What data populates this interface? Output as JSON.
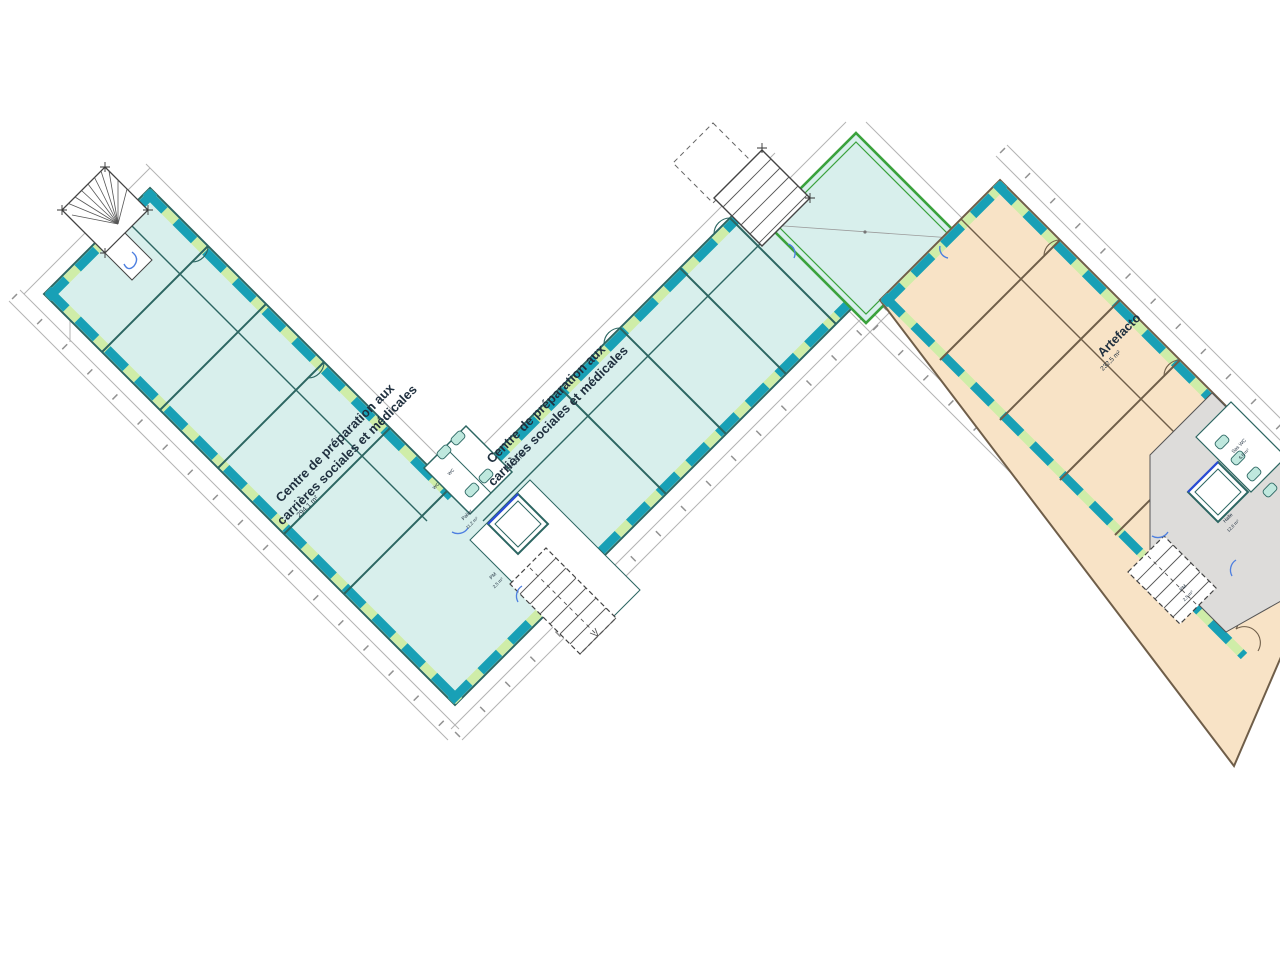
{
  "plan": {
    "zones": {
      "centre_left": {
        "line1": "Centre de préparation aux",
        "line2": "carrières sociales et médicales",
        "area": "294,1 m²"
      },
      "centre_mid": {
        "line1": "Centre de préparation aux",
        "line2": "carrières sociales et médicales",
        "area": "294,6 m²"
      },
      "artefacto": {
        "name": "Artefacto",
        "area": "232,5 m²"
      }
    },
    "core_left": {
      "palier": "Palier",
      "palier_area": "11,2 m²",
      "pm": "PM",
      "pm_area": "2,5 m²",
      "wc1": "WC",
      "wc2": "WC"
    },
    "core_right": {
      "halle": "Halle",
      "halle_area": "12,6 m²",
      "sas_wc": "Sas WC",
      "sas_wc_area": "6,6 m²",
      "pm": "PM",
      "pm_area": "2,5 m²"
    }
  },
  "colors": {
    "teal_interior": "#d8efec",
    "orange_interior": "#f8e3c6",
    "window_teal": "#18a0b6",
    "window_green": "#cfeda8",
    "wall_teal": "#2c6662",
    "wall_orange": "#6f5e49",
    "hall_green": "#3aa23c",
    "core_gray": "#dddcda",
    "elevator_blue": "#2a4bd7",
    "door_blue": "#4d7fe0",
    "label_color": "#20303f",
    "dimension_gray": "#9aa0a6"
  }
}
